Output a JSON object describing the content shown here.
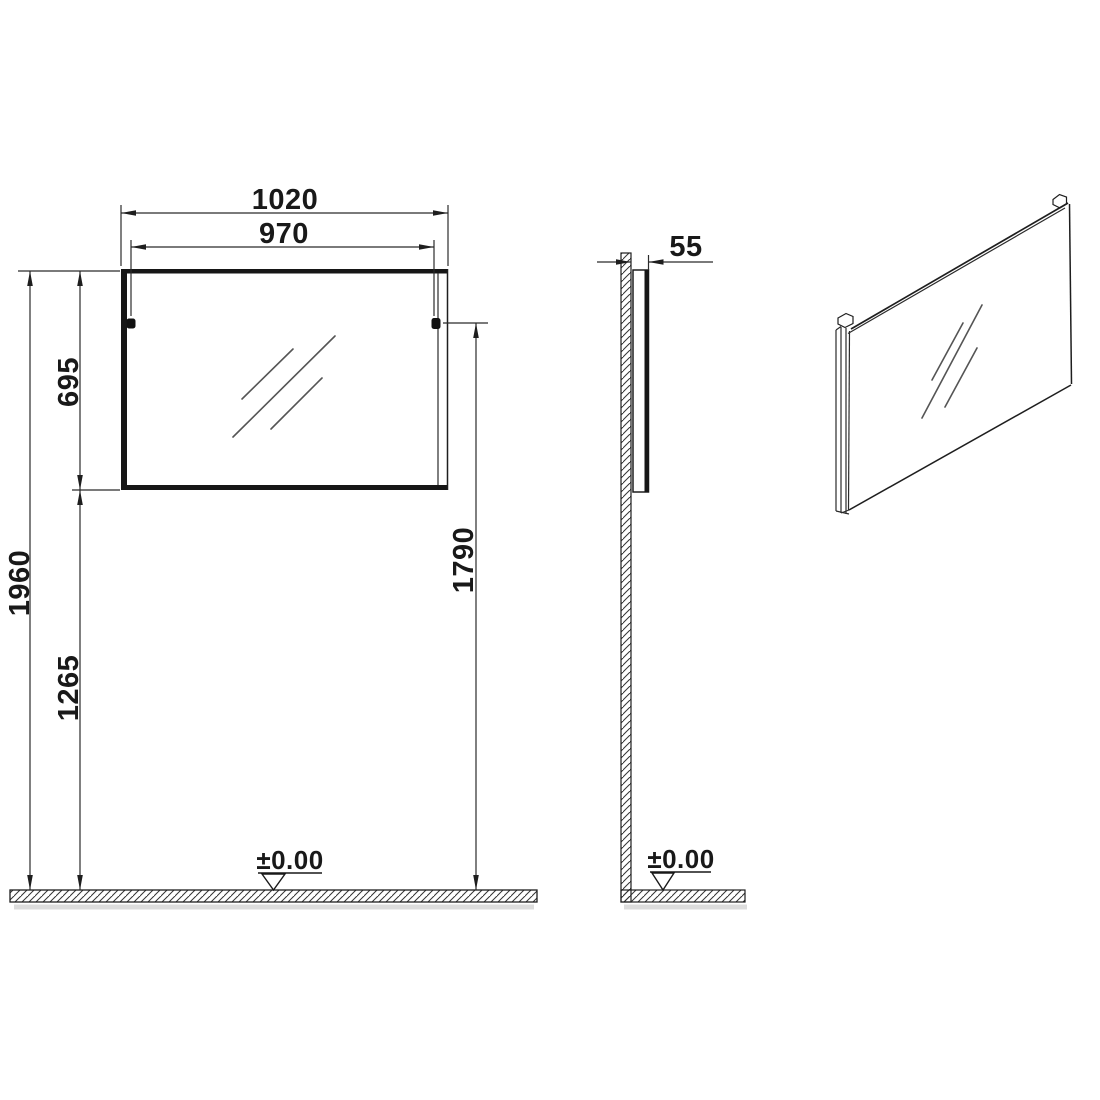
{
  "drawing_type": "mirror installation dimension drawing",
  "colors": {
    "line": "#1f1f1f",
    "reflection": "#555555",
    "floor_shadow": "#dcdcdc",
    "background": "#ffffff"
  },
  "front_view": {
    "overall_width": "1020",
    "fixing_width": "970",
    "mirror_height": "695",
    "overall_height": "1960",
    "mirror_bottom_height": "1265",
    "fixing_height": "1790",
    "floor_level": "±0.00"
  },
  "side_view": {
    "depth": "55",
    "floor_level": "±0.00"
  }
}
